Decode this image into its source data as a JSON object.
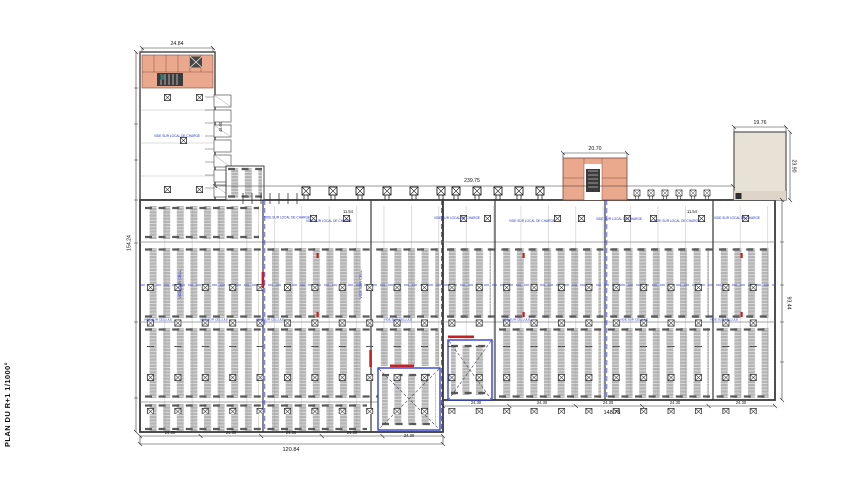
{
  "title": "PLAN DU R+1 1/1000°",
  "dims": {
    "tower_width": "24.84",
    "mid_annex_width": "20.70",
    "right_annex_width": "19.76",
    "right_annex_height": "23.90",
    "overall_width": "239.75",
    "left_height": "154.24",
    "right_height": "93.44",
    "bottom_left_overall": "120.84",
    "bottom_right_overall": "148.75",
    "bay": "24.30",
    "small_bay": "11.54",
    "tower_side": "45.00"
  },
  "ann": {
    "note": "VIDE SUR LOCAL DE CHARGE",
    "cell": "VIDE SUR CELLULE",
    "vide": "VIDE SUR CELL."
  },
  "colors": {
    "rack_gray": "#b5b5b5",
    "salmon": "#eaa88d",
    "beige": "#e8e1d6",
    "annotation_blue": "#2230c8",
    "axis_blue": "#3b42d8",
    "marker_red": "#c22222"
  }
}
